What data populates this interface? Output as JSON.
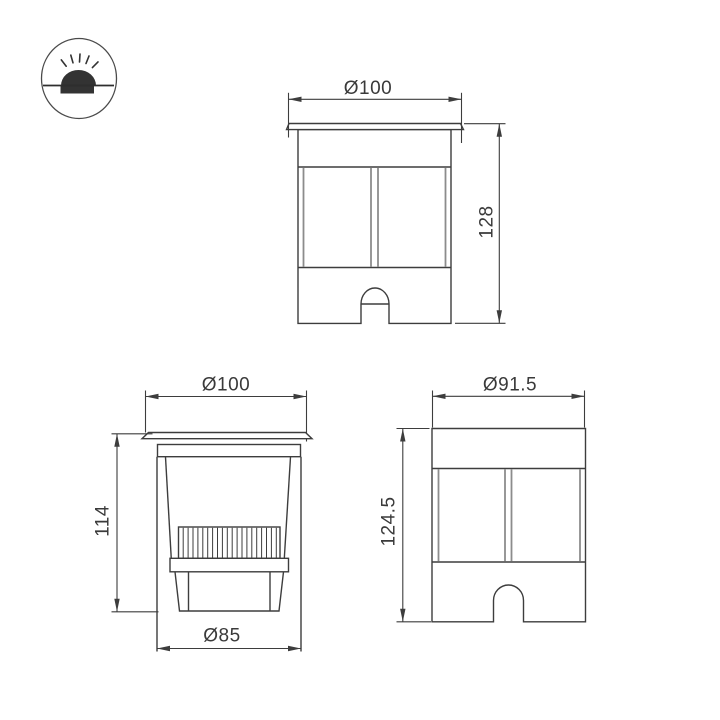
{
  "icon": {
    "type": "recessed-ground-light"
  },
  "views": {
    "front": {
      "diameter_label": "Ø100",
      "height_label": "128"
    },
    "section": {
      "diameter_label": "Ø100",
      "height_label": "114",
      "base_diameter_label": "Ø85"
    },
    "profile": {
      "diameter_label": "Ø91.5",
      "height_label": "124.5"
    }
  },
  "colors": {
    "line": "#3d3d3d",
    "glass_line": "#8c8c8c",
    "background": "#ffffff"
  }
}
